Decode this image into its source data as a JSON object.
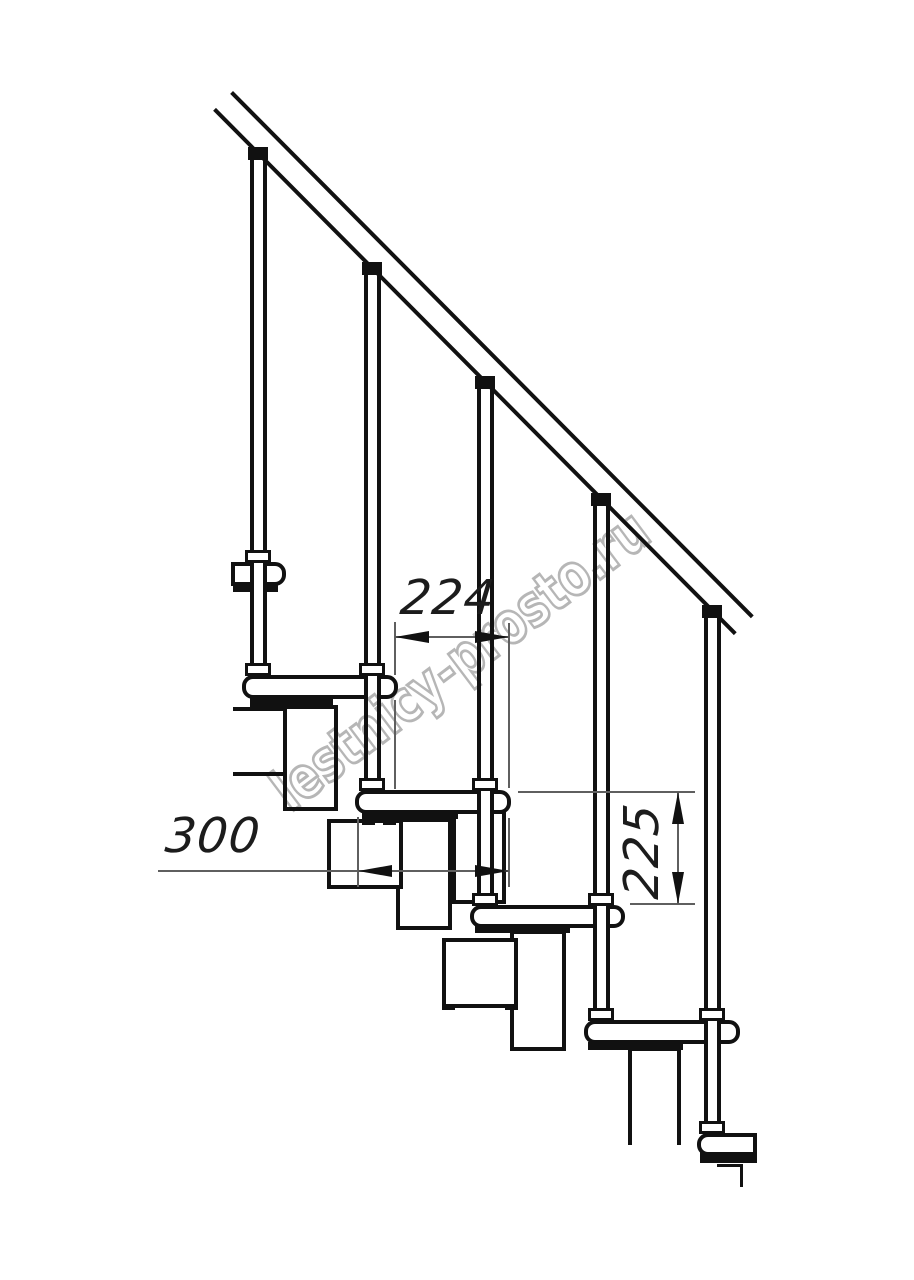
{
  "watermark": {
    "text": "lestnicy-prosto.ru"
  },
  "dimensions": {
    "run": {
      "value": "224"
    },
    "depth": {
      "value": "300"
    },
    "riser": {
      "value": "225"
    }
  },
  "colors": {
    "line": "#111111",
    "dimension_line": "#5f5f5f",
    "watermark": "#a9a9a9",
    "background": "#ffffff"
  }
}
